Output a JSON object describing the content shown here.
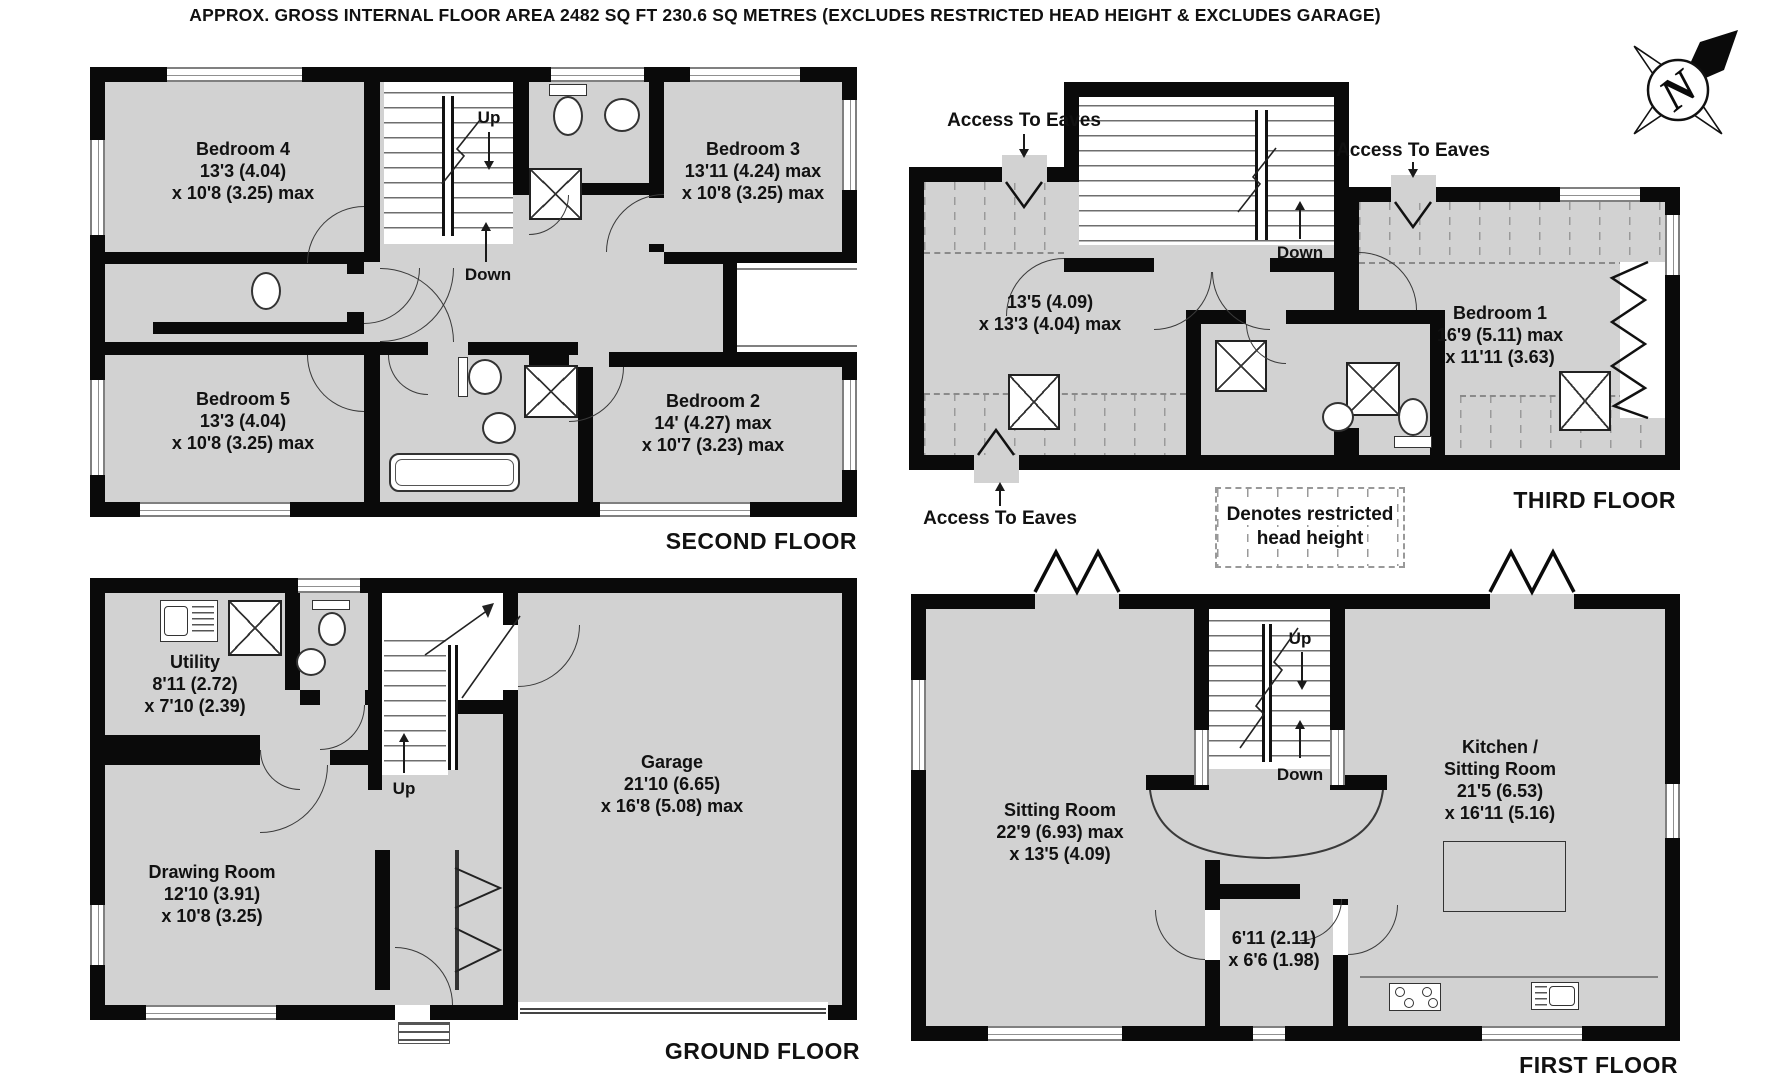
{
  "title": "APPROX. GROSS INTERNAL FLOOR AREA 2482 SQ FT 230.6 SQ METRES (EXCLUDES RESTRICTED HEAD HEIGHT & EXCLUDES GARAGE)",
  "compass": {
    "north": "N"
  },
  "legend": {
    "line1": "Denotes restricted",
    "line2": "head height"
  },
  "second_floor": {
    "label": "SECOND FLOOR",
    "bedroom4": {
      "name": "Bedroom 4",
      "dim1": "13'3 (4.04)",
      "dim2": "x 10'8 (3.25) max"
    },
    "bedroom3": {
      "name": "Bedroom 3",
      "dim1": "13'11 (4.24) max",
      "dim2": "x 10'8 (3.25) max"
    },
    "bedroom5": {
      "name": "Bedroom 5",
      "dim1": "13'3 (4.04)",
      "dim2": "x 10'8 (3.25) max"
    },
    "bedroom2": {
      "name": "Bedroom 2",
      "dim1": "14' (4.27) max",
      "dim2": "x 10'7 (3.23) max"
    },
    "up": "Up",
    "down": "Down"
  },
  "third_floor": {
    "label": "THIRD FLOOR",
    "bedroom6": {
      "name": "Bedroom 6",
      "dim1": "13'5 (4.09)",
      "dim2": "x 13'3 (4.04) max"
    },
    "bedroom1": {
      "name": "Bedroom 1",
      "dim1": "16'9 (5.11) max",
      "dim2": "x 11'11 (3.63)"
    },
    "down": "Down",
    "eaves_top": "Access To Eaves",
    "eaves_right": "Access To Eaves",
    "eaves_bottom": "Access To Eaves"
  },
  "ground_floor": {
    "label": "GROUND FLOOR",
    "utility": {
      "name": "Utility",
      "dim1": "8'11 (2.72)",
      "dim2": "x 7'10 (2.39)"
    },
    "garage": {
      "name": "Garage",
      "dim1": "21'10 (6.65)",
      "dim2": "x 16'8 (5.08) max"
    },
    "drawing_room": {
      "name": "Drawing Room",
      "dim1": "12'10 (3.91)",
      "dim2": "x 10'8 (3.25)"
    },
    "up": "Up"
  },
  "first_floor": {
    "label": "FIRST FLOOR",
    "sitting_room": {
      "name": "Sitting Room",
      "dim1": "22'9 (6.93) max",
      "dim2": "x 13'5 (4.09)"
    },
    "kitchen": {
      "name1": "Kitchen /",
      "name2": "Sitting Room",
      "dim1": "21'5 (6.53)",
      "dim2": "x 16'11 (5.16)"
    },
    "landing": {
      "dim1": "6'11 (2.11)",
      "dim2": "x 6'6 (1.98)"
    },
    "up": "Up",
    "down": "Down"
  }
}
